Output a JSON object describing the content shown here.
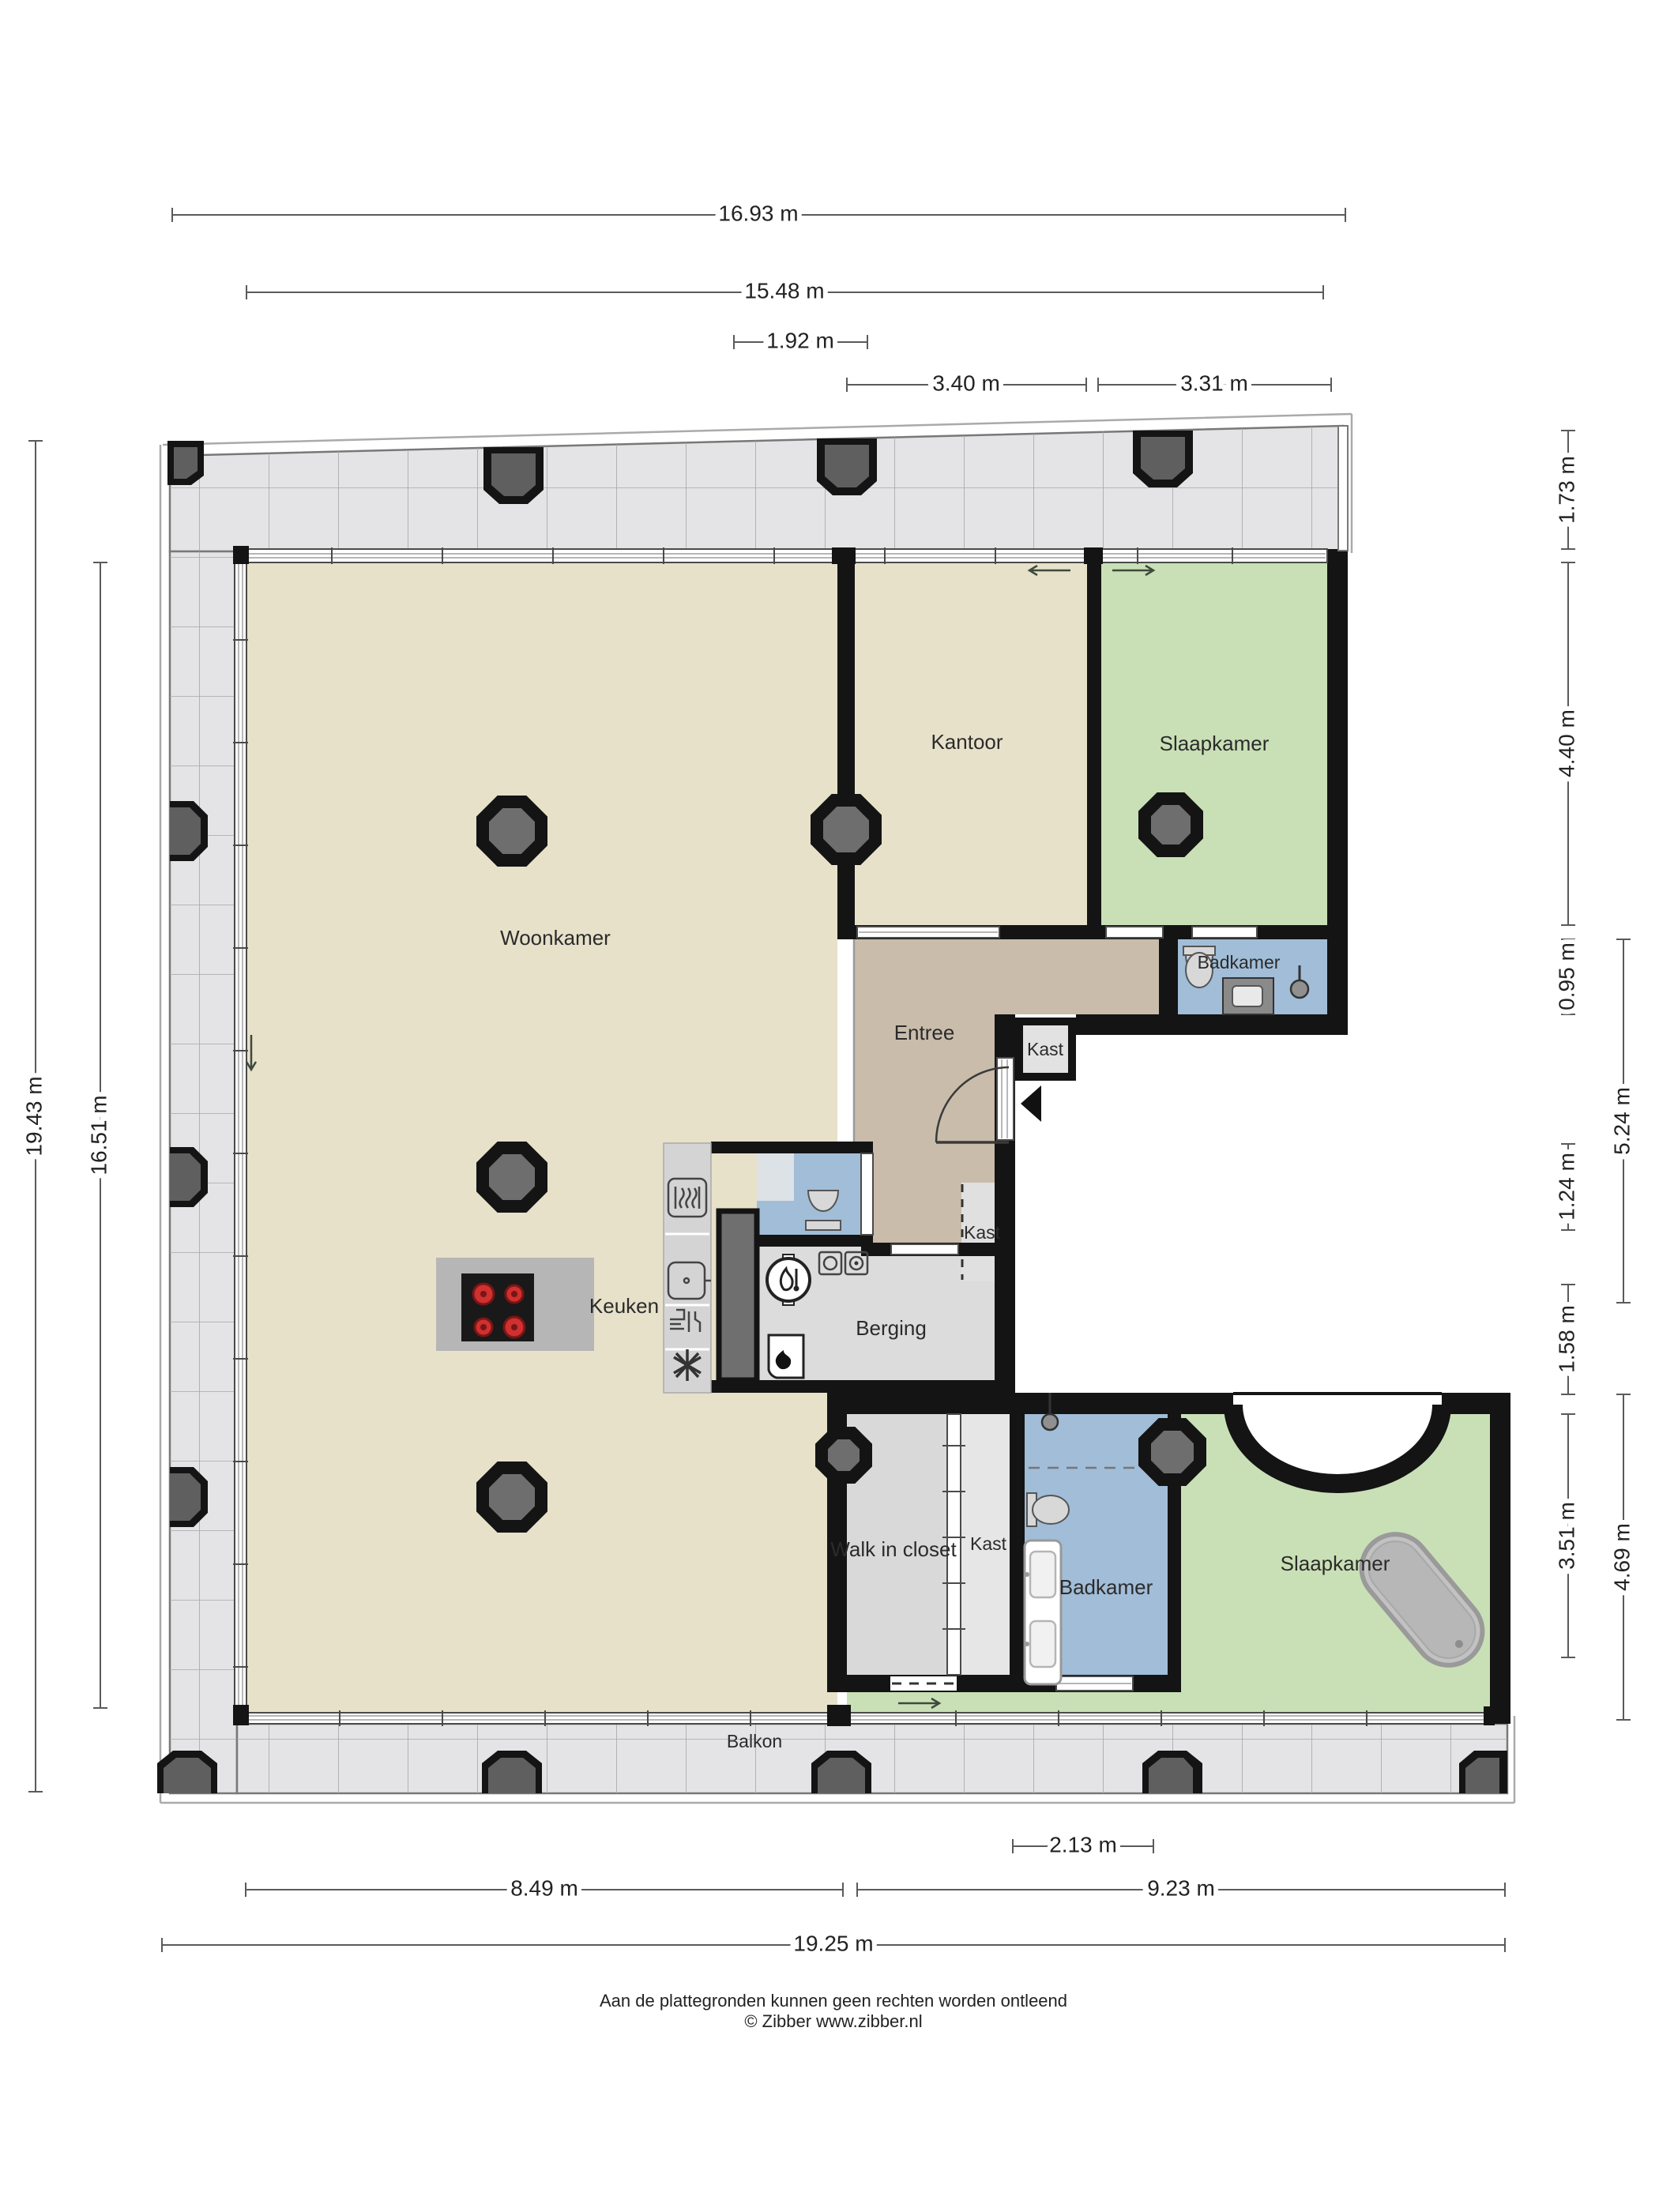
{
  "plan": {
    "title": "Floor plan (plattegrond)",
    "rooms": [
      {
        "id": "woonkamer",
        "label": "Woonkamer"
      },
      {
        "id": "kantoor",
        "label": "Kantoor"
      },
      {
        "id": "slaapkamer-top",
        "label": "Slaapkamer"
      },
      {
        "id": "badkamer-top",
        "label": "Badkamer"
      },
      {
        "id": "kast-a",
        "label": "Kast"
      },
      {
        "id": "entree",
        "label": "Entree"
      },
      {
        "id": "kast-b",
        "label": "Kast"
      },
      {
        "id": "keuken",
        "label": "Keuken"
      },
      {
        "id": "berging",
        "label": "Berging"
      },
      {
        "id": "walk-in-closet",
        "label": "Walk in closet"
      },
      {
        "id": "kast-c",
        "label": "Kast"
      },
      {
        "id": "badkamer-bottom",
        "label": "Badkamer"
      },
      {
        "id": "slaapkamer-bottom",
        "label": "Slaapkamer"
      },
      {
        "id": "balkon",
        "label": "Balkon"
      }
    ],
    "dimensions": {
      "top": [
        {
          "label": "16.93 m"
        },
        {
          "label": "15.48 m"
        },
        {
          "label": "1.92 m"
        },
        {
          "label": "3.40 m"
        },
        {
          "label": "3.31 m"
        }
      ],
      "left": [
        {
          "label": "19.43 m"
        },
        {
          "label": "16.51 m"
        }
      ],
      "right": [
        {
          "label": "1.73 m"
        },
        {
          "label": "4.40 m"
        },
        {
          "label": "0.95 m"
        },
        {
          "label": "5.24 m"
        },
        {
          "label": "1.24 m"
        },
        {
          "label": "1.58 m"
        },
        {
          "label": "3.51 m"
        },
        {
          "label": "4.69 m"
        }
      ],
      "bottom": [
        {
          "label": "2.13 m"
        },
        {
          "label": "8.49 m"
        },
        {
          "label": "9.23 m"
        },
        {
          "label": "19.25 m"
        }
      ]
    },
    "footer": {
      "line1": "Aan de plattegronden kunnen geen rechten worden ontleend",
      "line2": "© Zibber www.zibber.nl"
    },
    "colors": {
      "floor_living": "#e7e1ca",
      "floor_entree": "#c9bcaa",
      "floor_bedroom": "#c9e0b6",
      "floor_bathroom": "#a1bdd8",
      "floor_storage": "#dcdcdc",
      "balcony_deck": "#e4e4e6",
      "walls": "#141414",
      "column": "#6e6e6e",
      "cooktop_burner": "#cf3030"
    }
  }
}
